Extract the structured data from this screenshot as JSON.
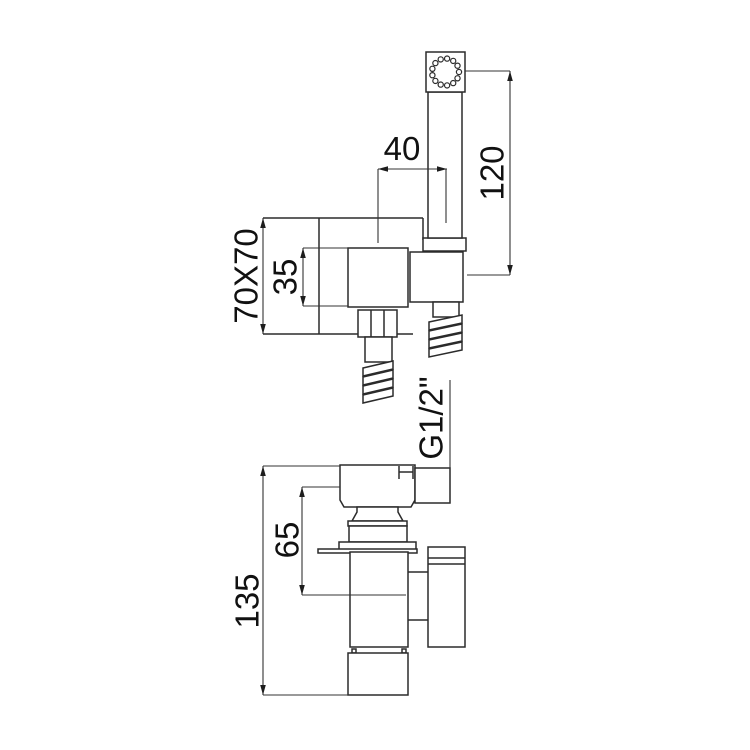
{
  "page": {
    "background": "#ffffff",
    "line_color": "#2b2b2b",
    "dim_color": "#111111"
  },
  "drawing": {
    "kind": "technical dimension drawing",
    "subject": "wall-mounted bidet mixer with hand shower, side view (top) and front view (bottom)"
  },
  "dimensions": {
    "handle_offset": "40",
    "shower_length": "120",
    "plate_size": "70X70",
    "knob_size": "35",
    "thread_size": "G1/2\"",
    "upper_offset": "65",
    "total_height": "135"
  }
}
